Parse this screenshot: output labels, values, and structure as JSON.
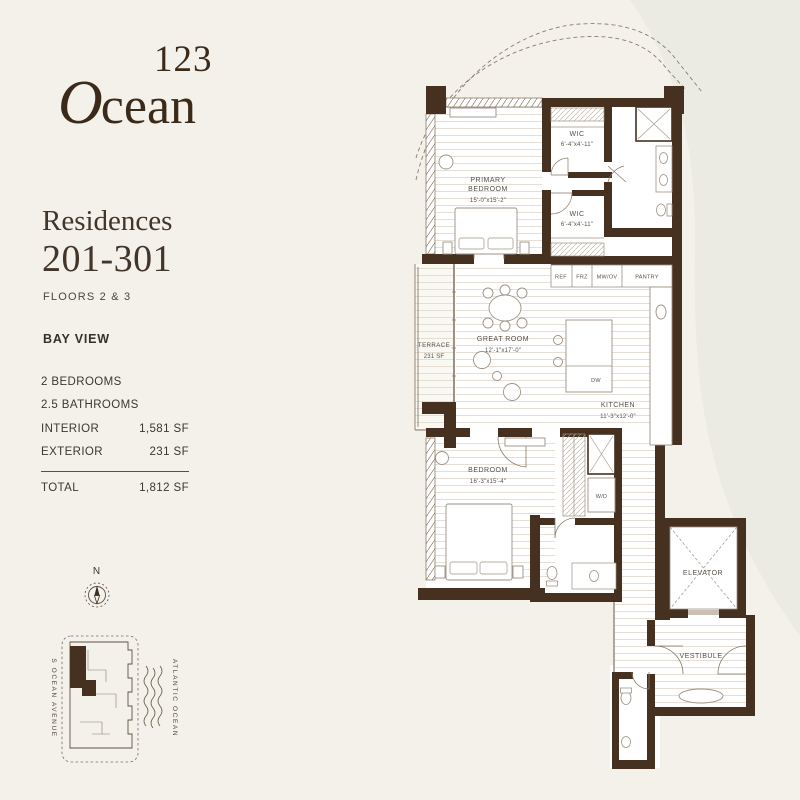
{
  "colors": {
    "wall": "#46301f",
    "background": "#f3f1ea",
    "swoosh": "#ebeae3",
    "ink": "#3b2a1a"
  },
  "logo": {
    "number": "123",
    "word_cap": "O",
    "word_rest": "cean"
  },
  "panel": {
    "title1": "Residences",
    "title2": "201-301",
    "floors": "FLOORS 2 & 3",
    "view": "BAY VIEW",
    "stats": [
      {
        "label": "2 BEDROOMS",
        "value": ""
      },
      {
        "label": "2.5 BATHROOMS",
        "value": ""
      },
      {
        "label": "INTERIOR",
        "value": "1,581 SF"
      },
      {
        "label": "EXTERIOR",
        "value": "231 SF"
      }
    ],
    "total": {
      "label": "TOTAL",
      "value": "1,812 SF"
    }
  },
  "compass": {
    "north": "N"
  },
  "keyplan": {
    "street": "S OCEAN AVENUE",
    "ocean": "ATLANTIC OCEAN"
  },
  "plan": {
    "rooms": {
      "wic1": {
        "name": "WIC",
        "dims": "6'-4\"x4'-11\""
      },
      "primary_bedroom": {
        "line1": "PRIMARY",
        "line2": "BEDROOM",
        "dims": "15'-0\"x15'-2\""
      },
      "wic2": {
        "name": "WIC",
        "dims": "6'-4\"x4'-11\""
      },
      "terrace": {
        "name": "TERRACE",
        "dims": "231 SF"
      },
      "great_room": {
        "name": "GREAT ROOM",
        "dims": "12'-1\"x17'-0\""
      },
      "kitchen": {
        "name": "KITCHEN",
        "dims": "11'-3\"x12'-0\""
      },
      "bedroom": {
        "name": "BEDROOM",
        "dims": "16'-3\"x15'-4\""
      },
      "elevator": {
        "name": "ELEVATOR"
      },
      "vestibule": {
        "name": "VESTIBULE"
      }
    },
    "appliances": [
      "REF",
      "FRZ",
      "MW/OV",
      "PANTRY"
    ],
    "fixtures": {
      "dw": "DW",
      "wd": "W/D"
    }
  }
}
